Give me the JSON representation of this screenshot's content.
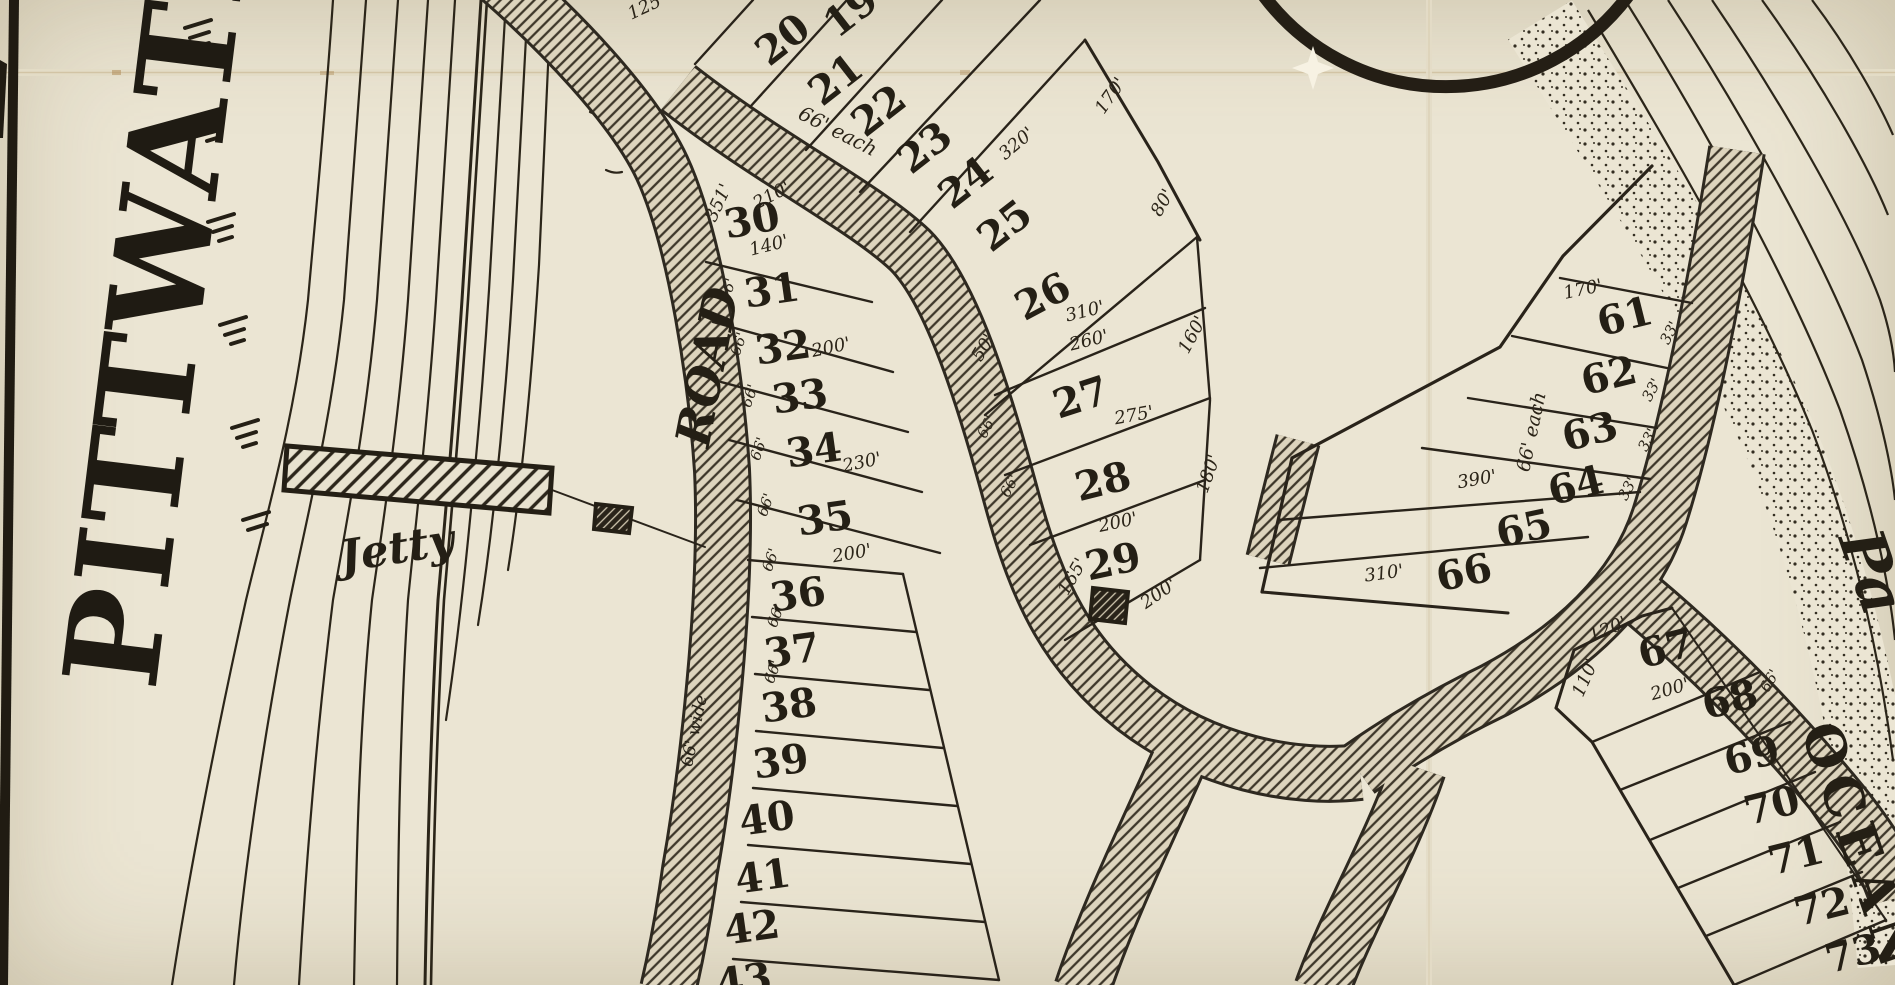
{
  "map": {
    "type": "historical-subdivision-plan",
    "colors": {
      "paper": "#ebe5d3",
      "ink": "#241f15",
      "crease": "#cdbd9b"
    },
    "water_label": {
      "text": "PITTWATER"
    },
    "labels": [
      {
        "name": "jetty-label",
        "text": "Jetty",
        "x": 397,
        "y": 549,
        "rot": -9,
        "fs": 44,
        "style": "script",
        "weight": 700
      },
      {
        "name": "road-label",
        "text": "ROAD",
        "x": 708,
        "y": 367,
        "rot": -79,
        "fs": 48,
        "style": "script",
        "weight": 700
      },
      {
        "name": "road-width-label",
        "text": "66' wide",
        "x": 695,
        "y": 731,
        "rot": -78,
        "fs": 17,
        "style": "script",
        "weight": 500
      },
      {
        "name": "ocean-label",
        "text": "OCEAN",
        "x": 1861,
        "y": 848,
        "rot": 71,
        "fs": 54,
        "style": "plain",
        "weight": 700
      },
      {
        "name": "pacific-fragment",
        "text": "Pa",
        "x": 1872,
        "y": 572,
        "rot": 71,
        "fs": 62,
        "style": "script",
        "weight": 700
      }
    ],
    "lots": [
      {
        "n": "19",
        "x": 851,
        "y": 12,
        "r": -38
      },
      {
        "n": "20",
        "x": 783,
        "y": 40,
        "r": -38
      },
      {
        "n": "21",
        "x": 836,
        "y": 80,
        "r": -38
      },
      {
        "n": "22",
        "x": 879,
        "y": 111,
        "r": -38
      },
      {
        "n": "23",
        "x": 925,
        "y": 148,
        "r": -38
      },
      {
        "n": "24",
        "x": 966,
        "y": 183,
        "r": -38
      },
      {
        "n": "25",
        "x": 1005,
        "y": 226,
        "r": -38
      },
      {
        "n": "26",
        "x": 1043,
        "y": 297,
        "r": -28
      },
      {
        "n": "27",
        "x": 1081,
        "y": 398,
        "r": -18
      },
      {
        "n": "28",
        "x": 1103,
        "y": 482,
        "r": -14
      },
      {
        "n": "29",
        "x": 1113,
        "y": 562,
        "r": -12
      },
      {
        "n": "30",
        "x": 752,
        "y": 221,
        "r": -10
      },
      {
        "n": "31",
        "x": 772,
        "y": 291,
        "r": -8
      },
      {
        "n": "32",
        "x": 783,
        "y": 348,
        "r": -8
      },
      {
        "n": "33",
        "x": 800,
        "y": 397,
        "r": -8
      },
      {
        "n": "34",
        "x": 814,
        "y": 451,
        "r": -8
      },
      {
        "n": "35",
        "x": 825,
        "y": 519,
        "r": -8
      },
      {
        "n": "36",
        "x": 798,
        "y": 595,
        "r": -8
      },
      {
        "n": "37",
        "x": 792,
        "y": 651,
        "r": -8
      },
      {
        "n": "38",
        "x": 789,
        "y": 706,
        "r": -8
      },
      {
        "n": "39",
        "x": 781,
        "y": 762,
        "r": -8
      },
      {
        "n": "40",
        "x": 767,
        "y": 819,
        "r": -8
      },
      {
        "n": "41",
        "x": 763,
        "y": 877,
        "r": -8
      },
      {
        "n": "42",
        "x": 752,
        "y": 928,
        "r": -8
      },
      {
        "n": "43",
        "x": 744,
        "y": 981,
        "r": -8
      },
      {
        "n": "61",
        "x": 1625,
        "y": 317,
        "r": -14
      },
      {
        "n": "62",
        "x": 1609,
        "y": 376,
        "r": -14
      },
      {
        "n": "63",
        "x": 1590,
        "y": 432,
        "r": -14
      },
      {
        "n": "64",
        "x": 1576,
        "y": 486,
        "r": -14
      },
      {
        "n": "65",
        "x": 1524,
        "y": 529,
        "r": -12
      },
      {
        "n": "66",
        "x": 1464,
        "y": 573,
        "r": -12
      },
      {
        "n": "67",
        "x": 1666,
        "y": 649,
        "r": -14
      },
      {
        "n": "68",
        "x": 1730,
        "y": 700,
        "r": -14
      },
      {
        "n": "69",
        "x": 1752,
        "y": 756,
        "r": -14
      },
      {
        "n": "70",
        "x": 1772,
        "y": 806,
        "r": -14
      },
      {
        "n": "71",
        "x": 1796,
        "y": 856,
        "r": -14
      },
      {
        "n": "72",
        "x": 1822,
        "y": 907,
        "r": -14
      },
      {
        "n": "73",
        "x": 1853,
        "y": 954,
        "r": -14
      }
    ],
    "measurements": [
      {
        "t": "125'",
        "x": 647,
        "y": 7,
        "r": -25
      },
      {
        "t": "170'",
        "x": 1111,
        "y": 96,
        "r": -55
      },
      {
        "t": "320'",
        "x": 1017,
        "y": 144,
        "r": -40
      },
      {
        "t": "80'",
        "x": 1163,
        "y": 203,
        "r": -60
      },
      {
        "t": "66' each",
        "x": 838,
        "y": 131,
        "r": 27,
        "fs": 20
      },
      {
        "t": "351'",
        "x": 719,
        "y": 203,
        "r": -65
      },
      {
        "t": "210'",
        "x": 772,
        "y": 196,
        "r": -28
      },
      {
        "t": "140'",
        "x": 769,
        "y": 246,
        "r": -14
      },
      {
        "t": "200'",
        "x": 831,
        "y": 348,
        "r": -12
      },
      {
        "t": "230'",
        "x": 862,
        "y": 463,
        "r": -12
      },
      {
        "t": "200'",
        "x": 852,
        "y": 554,
        "r": -10
      },
      {
        "t": "50'",
        "x": 984,
        "y": 348,
        "r": -58
      },
      {
        "t": "310'",
        "x": 1085,
        "y": 312,
        "r": -14
      },
      {
        "t": "260'",
        "x": 1089,
        "y": 341,
        "r": -14
      },
      {
        "t": "160'",
        "x": 1193,
        "y": 335,
        "r": -62
      },
      {
        "t": "275'",
        "x": 1134,
        "y": 416,
        "r": -10
      },
      {
        "t": "66'",
        "x": 987,
        "y": 427,
        "r": -62,
        "fs": 15
      },
      {
        "t": "66'",
        "x": 1010,
        "y": 486,
        "r": -62,
        "fs": 15
      },
      {
        "t": "200'",
        "x": 1118,
        "y": 523,
        "r": -12
      },
      {
        "t": "165'",
        "x": 1073,
        "y": 577,
        "r": -60
      },
      {
        "t": "200'",
        "x": 1159,
        "y": 594,
        "r": -35
      },
      {
        "t": "180'",
        "x": 1209,
        "y": 474,
        "r": -70
      },
      {
        "t": "66'",
        "x": 728,
        "y": 290,
        "r": -70,
        "fs": 15
      },
      {
        "t": "66'",
        "x": 739,
        "y": 344,
        "r": -70,
        "fs": 15
      },
      {
        "t": "66'",
        "x": 750,
        "y": 396,
        "r": -70,
        "fs": 15
      },
      {
        "t": "66'",
        "x": 759,
        "y": 449,
        "r": -70,
        "fs": 15
      },
      {
        "t": "66'",
        "x": 766,
        "y": 505,
        "r": -70,
        "fs": 15
      },
      {
        "t": "66'",
        "x": 771,
        "y": 560,
        "r": -70,
        "fs": 15
      },
      {
        "t": "66'",
        "x": 776,
        "y": 616,
        "r": -70,
        "fs": 15
      },
      {
        "t": "66'",
        "x": 773,
        "y": 672,
        "r": -70,
        "fs": 15
      },
      {
        "t": "170'",
        "x": 1583,
        "y": 290,
        "r": -12
      },
      {
        "t": "33'",
        "x": 1670,
        "y": 333,
        "r": -62,
        "fs": 15
      },
      {
        "t": "33'",
        "x": 1652,
        "y": 390,
        "r": -62,
        "fs": 15
      },
      {
        "t": "33'",
        "x": 1648,
        "y": 440,
        "r": -62,
        "fs": 15
      },
      {
        "t": "33'",
        "x": 1628,
        "y": 489,
        "r": -62,
        "fs": 15
      },
      {
        "t": "66' each",
        "x": 1532,
        "y": 432,
        "r": -78,
        "fs": 19
      },
      {
        "t": "390'",
        "x": 1477,
        "y": 480,
        "r": -10
      },
      {
        "t": "310'",
        "x": 1384,
        "y": 574,
        "r": -8
      },
      {
        "t": "120'",
        "x": 1608,
        "y": 630,
        "r": -22
      },
      {
        "t": "110'",
        "x": 1586,
        "y": 678,
        "r": -66
      },
      {
        "t": "200'",
        "x": 1670,
        "y": 690,
        "r": -16
      },
      {
        "t": "66'",
        "x": 1770,
        "y": 681,
        "r": -60,
        "fs": 15
      }
    ]
  }
}
